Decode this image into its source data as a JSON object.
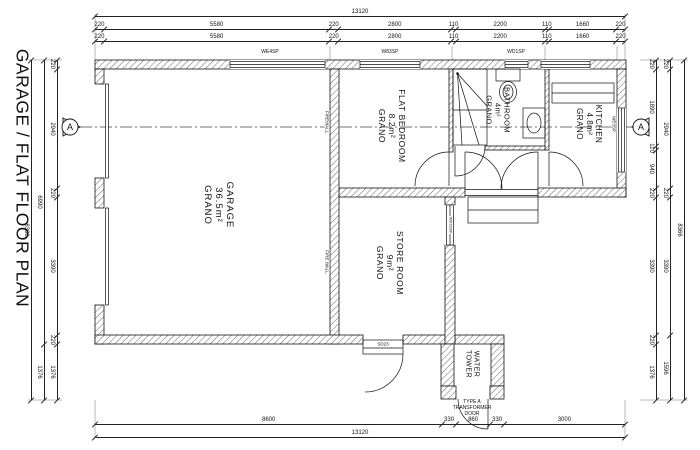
{
  "title": "GARAGE / FLAT FLOOR PLAN",
  "section_marker": {
    "letter": "A"
  },
  "scale": {
    "px_per_mm_h": 0.040396,
    "px_per_mm_v": 0.040641,
    "plan_left_px": 95,
    "plan_top_px": 60
  },
  "dimensions": {
    "top": [
      {
        "y": 16,
        "segments": [
          13120
        ]
      },
      {
        "y": 29,
        "segments": [
          220,
          5580,
          220,
          2800,
          110,
          2200,
          110,
          1660,
          220
        ]
      },
      {
        "y": 41,
        "segments": [
          220,
          5580,
          220,
          2800,
          110,
          2200,
          110,
          1660,
          220
        ]
      }
    ],
    "bottom": [
      {
        "y": 424,
        "segments": [
          8600,
          330,
          860,
          330,
          3000
        ]
      },
      {
        "y": 437,
        "segments": [
          13120
        ]
      }
    ],
    "left": [
      {
        "x": 57,
        "segments": [
          220,
          2940,
          220,
          3390,
          220,
          1376
        ]
      },
      {
        "x": 44,
        "segments": [
          6990,
          1376
        ]
      },
      {
        "x": 31,
        "segments": [
          8366
        ]
      }
    ],
    "right": [
      {
        "x": 656,
        "segments": [
          220,
          1890,
          110,
          940,
          220,
          3390,
          220,
          1376
        ]
      },
      {
        "x": 670,
        "segments": [
          220,
          2940,
          220,
          3390,
          1596
        ]
      },
      {
        "x": 684,
        "segments": [
          8366
        ]
      }
    ]
  },
  "labels": [
    {
      "name": "room-label-garage",
      "lines": [
        "GARAGE",
        "36.5m²",
        "GRANO"
      ],
      "x": 218,
      "y": 205,
      "rot": 1,
      "size": 9.5,
      "ls": 1
    },
    {
      "name": "room-label-flat-bedroom",
      "lines": [
        "FLAT BEDROOM",
        "8.2m²",
        "GRANO"
      ],
      "x": 392,
      "y": 126,
      "rot": 1,
      "size": 8.5,
      "ls": 0.6
    },
    {
      "name": "room-label-bathroom",
      "lines": [
        "BATHROOM",
        "4m²",
        "GRANO"
      ],
      "x": 497,
      "y": 110,
      "rot": 1,
      "size": 7.5,
      "ls": 0.4
    },
    {
      "name": "room-label-kitchen",
      "lines": [
        "KITCHEN",
        "4.8m²",
        "GRANO"
      ],
      "x": 589,
      "y": 124,
      "rot": 1,
      "size": 8,
      "ls": 0.5
    },
    {
      "name": "room-label-store-room",
      "lines": [
        "STORE ROOM",
        "9m²",
        "GRANO"
      ],
      "x": 390,
      "y": 263,
      "rot": 1,
      "size": 8.5,
      "ls": 0.6
    },
    {
      "name": "room-label-water-tower",
      "lines": [
        "WATER",
        "TOWER"
      ],
      "x": 471,
      "y": 364,
      "rot": 1,
      "size": 7,
      "ls": 0.4
    },
    {
      "name": "label-transformer-door",
      "lines": [
        "TYPE A",
        "TRANSFORMER",
        "DOOR"
      ],
      "x": 472,
      "y": 409,
      "rot": 0,
      "size": 5
    },
    {
      "name": "label-sd23",
      "lines": [
        "SD23"
      ],
      "x": 383,
      "y": 344,
      "rot": 0,
      "size": 4.5,
      "bg": 1
    },
    {
      "name": "label-firewall-upper",
      "lines": [
        "FIREWALL"
      ],
      "x": 327,
      "y": 122,
      "rot": 1,
      "size": 4.5,
      "bg": 1
    },
    {
      "name": "label-firewall-lower",
      "lines": [
        "FIRE WALL"
      ],
      "x": 327,
      "y": 262,
      "rot": 1,
      "size": 4.5,
      "bg": 1
    },
    {
      "name": "window-label-we4sp",
      "lines": [
        "WE4SP"
      ],
      "x": 270,
      "y": 53,
      "rot": 0,
      "size": 5
    },
    {
      "name": "window-label-w83sp",
      "lines": [
        "W83SP"
      ],
      "x": 390,
      "y": 53,
      "rot": 0,
      "size": 5
    },
    {
      "name": "window-label-wd1sp",
      "lines": [
        "WD1SP"
      ],
      "x": 516,
      "y": 53,
      "rot": 0,
      "size": 5
    },
    {
      "name": "window-label-we3sp",
      "lines": [
        "WE3SP"
      ],
      "x": 614,
      "y": 124,
      "rot": 1,
      "size": 4.5,
      "bg": 1
    },
    {
      "name": "window-label-wd22sp",
      "lines": [
        "WD22SP"
      ],
      "x": 450,
      "y": 225,
      "rot": 1,
      "size": 4,
      "bg": 1
    }
  ]
}
